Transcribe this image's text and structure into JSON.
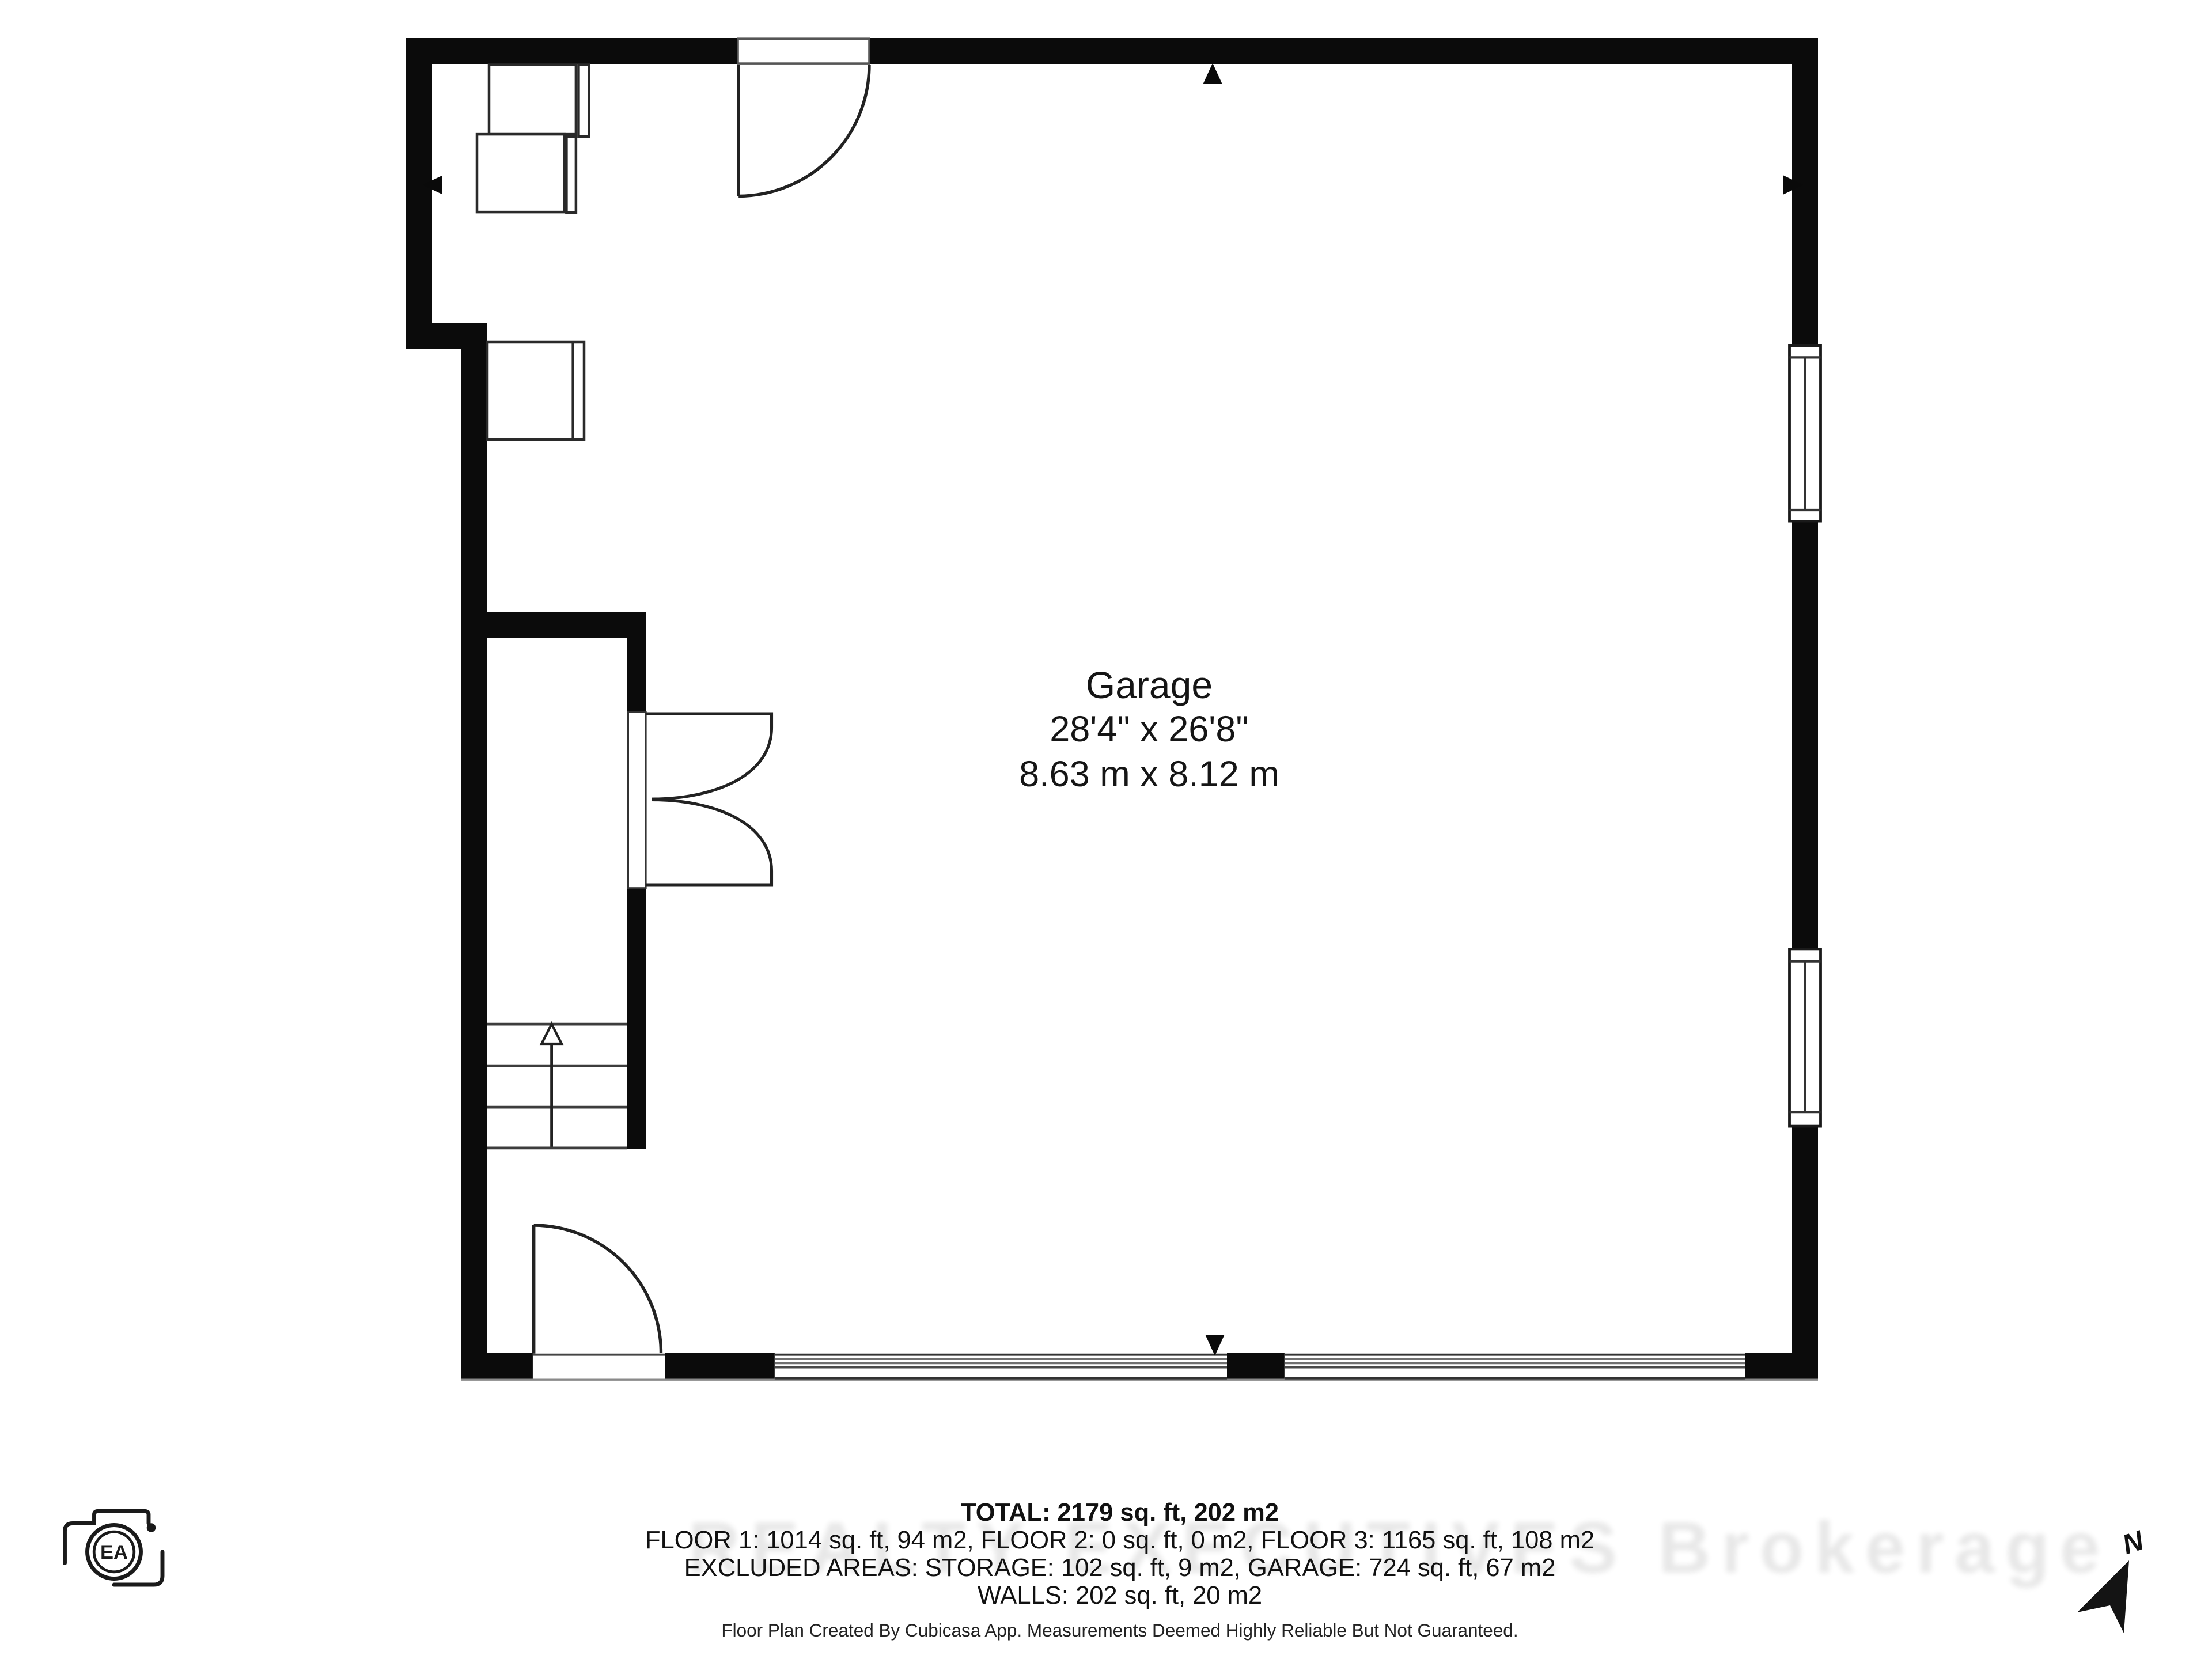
{
  "room_label": {
    "name": "Garage",
    "dimensions_imperial": "28'4\" x 26'8\"",
    "dimensions_metric": "8.63 m x 8.12 m"
  },
  "area_summary": {
    "total": "TOTAL: 2179 sq. ft, 202 m2",
    "floors": "FLOOR 1: 1014 sq. ft, 94 m2, FLOOR 2: 0 sq. ft, 0 m2, FLOOR 3: 1165 sq. ft, 108 m2",
    "excluded_areas": "EXCLUDED AREAS: STORAGE: 102 sq. ft, 9 m2, GARAGE: 724 sq. ft, 67 m2",
    "walls": "WALLS: 202 sq. ft, 20 m2"
  },
  "disclaimer": "Floor Plan Created By Cubicasa App. Measurements Deemed Highly Reliable But Not Guaranteed.",
  "watermark": "REALTY EXECUTIVES Brokerage",
  "compass": {
    "label": "N"
  },
  "camera_logo": {
    "label": "EA"
  },
  "colors": {
    "wall": "#0b0b0b",
    "thin_line": "#3a3a3a",
    "text": "#111111",
    "background": "#ffffff"
  }
}
